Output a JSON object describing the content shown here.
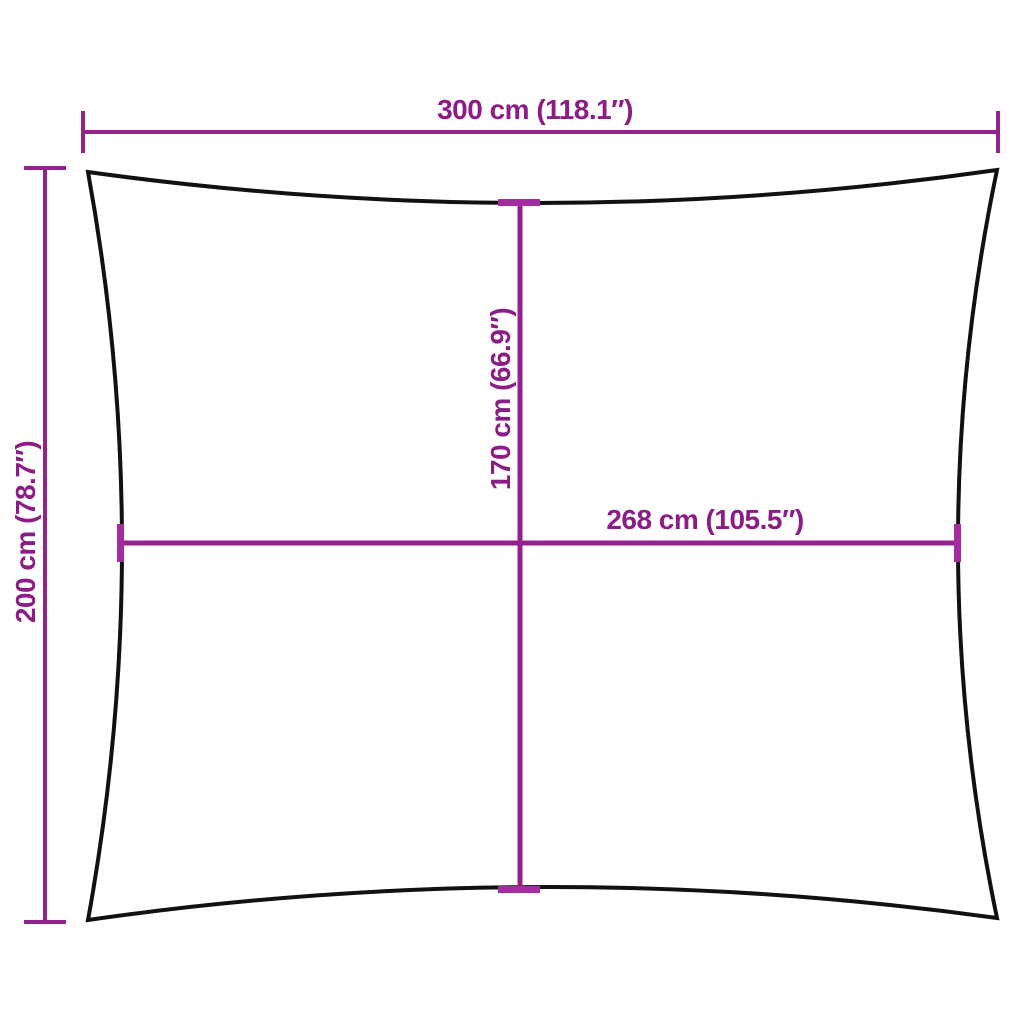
{
  "diagram": {
    "dimensions": {
      "width": {
        "label": "300 cm (118.1″)",
        "value_cm": 300,
        "value_in": 118.1
      },
      "height": {
        "label": "200 cm (78.7″)",
        "value_cm": 200,
        "value_in": 78.7
      },
      "inner_height": {
        "label": "170 cm (66.9″)",
        "value_cm": 170,
        "value_in": 66.9
      },
      "inner_width": {
        "label": "268 cm (105.5″)",
        "value_cm": 268,
        "value_in": 105.5
      }
    }
  },
  "colors": {
    "dimension-line": "#93218e",
    "dimension-tick": "#a42ba0",
    "dimension-text": "#8c1d87",
    "outline": "#111111",
    "background": "#ffffff"
  }
}
